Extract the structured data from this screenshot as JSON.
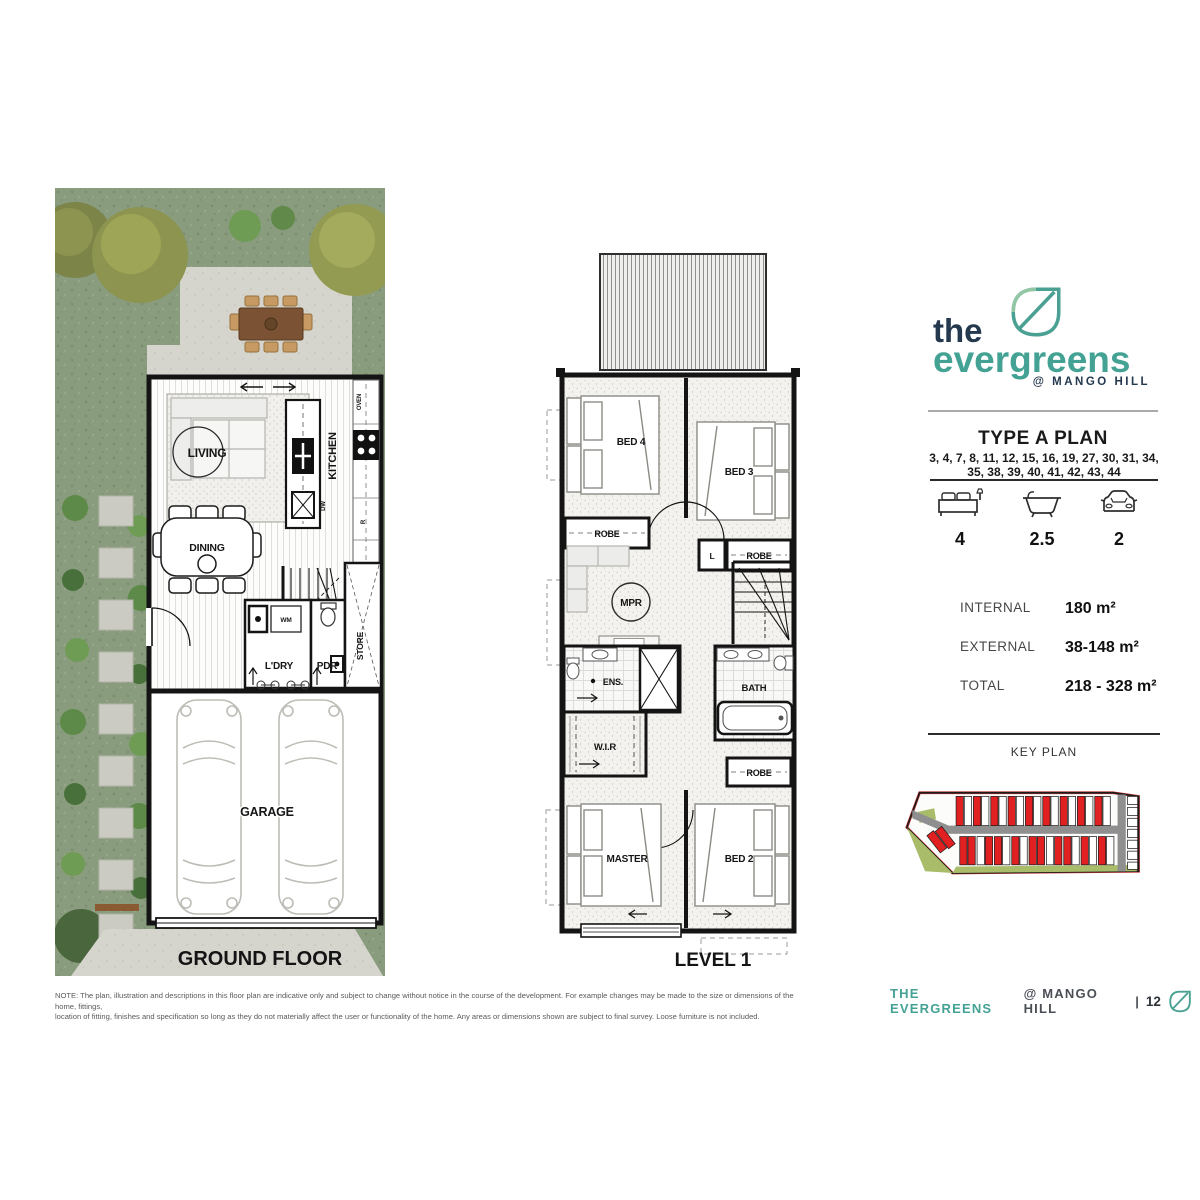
{
  "brand": {
    "the": "the",
    "name": "evergreens",
    "tagline": "@ MANGO HILL"
  },
  "plan_info": {
    "title": "TYPE A PLAN",
    "lots_line1": "3, 4, 7, 8, 11, 12, 15, 16, 19, 27, 30, 31, 34,",
    "lots_line2": "35, 38, 39, 40, 41, 42, 43, 44",
    "stats": {
      "beds": "4",
      "baths": "2.5",
      "cars": "2"
    },
    "areas": [
      {
        "label": "INTERNAL",
        "value": "180 m²"
      },
      {
        "label": "EXTERNAL",
        "value": "38-148 m²"
      },
      {
        "label": "TOTAL",
        "value": "218 - 328 m²"
      }
    ],
    "key_plan_title": "KEY PLAN"
  },
  "ground_floor": {
    "caption": "GROUND FLOOR",
    "labels": {
      "living": "LIVING",
      "dining": "DINING",
      "kitchen": "KITCHEN",
      "oven": "OVEN",
      "dw": "DW",
      "fridge": "R",
      "wm": "WM",
      "ldry": "L'DRY",
      "pdr": "PDR",
      "store": "STORE",
      "garage": "GARAGE"
    }
  },
  "level1": {
    "caption": "LEVEL 1",
    "labels": {
      "bed4": "BED 4",
      "bed3": "BED 3",
      "robe_bed4": "ROBE",
      "linen": "L",
      "robe_bed3": "ROBE",
      "mpr": "MPR",
      "ens": "ENS.",
      "wir": "W.I.R",
      "bath": "BATH",
      "robe_bed2": "ROBE",
      "master": "MASTER",
      "bed2": "BED 2"
    }
  },
  "note": {
    "line1": "NOTE: The plan, illustration and descriptions in this floor plan are indicative only and subject to change without notice in the course of the development. For example changes may be made to the size or dimensions of the home, fittings,",
    "line2": "location of fitting, finishes and specification so long as they do not materially affect the user or functionality of the home. Any areas or dimensions shown are subject to final survey. Loose furniture is not included."
  },
  "footer": {
    "brand": "THE EVERGREENS",
    "tagline": "@ MANGO HILL",
    "separator": "|",
    "page": "12"
  },
  "colors": {
    "teal": "#44A295",
    "navy": "#24384E",
    "lot_red": "#E02021",
    "key_green": "#A9BC6A",
    "grass": "#8A9C7E"
  }
}
